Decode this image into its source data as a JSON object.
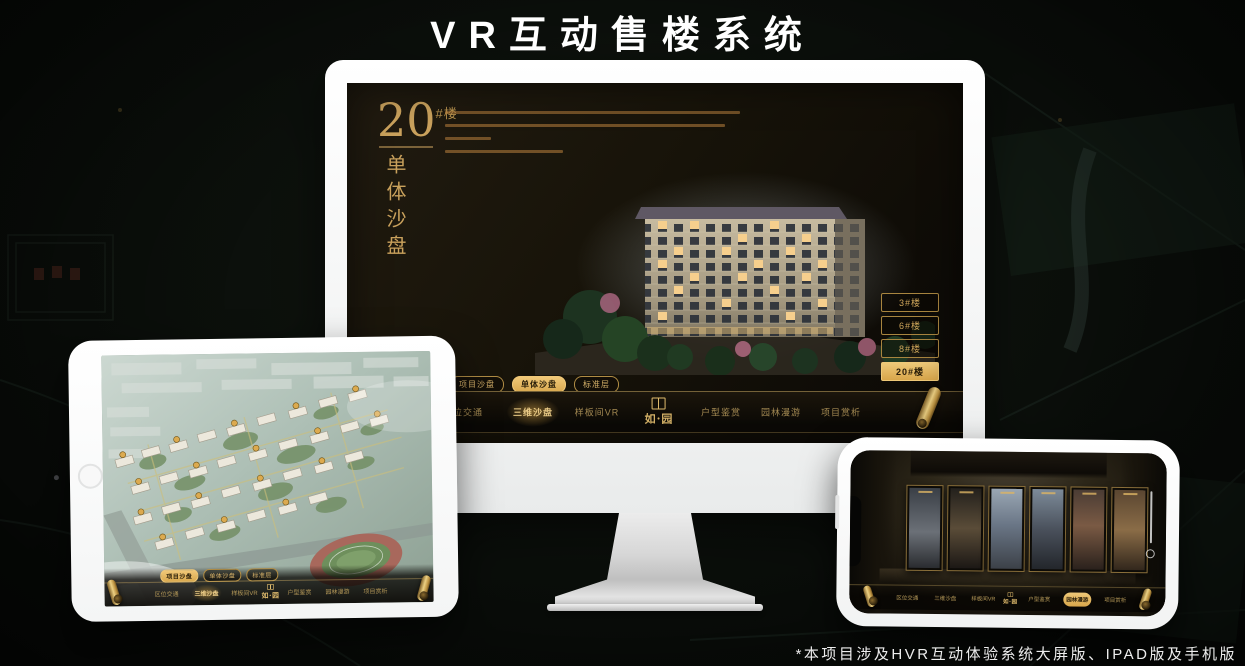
{
  "page": {
    "title": "VR互动售楼系统",
    "footnote": "*本项目涉及HVR互动体验系统大屏版、IPAD版及手机版"
  },
  "brand": {
    "logo_text": "如·园"
  },
  "colors": {
    "gold": "#c9a15c",
    "gold_bright": "#eec878",
    "screen_dark": "#171309"
  },
  "desktop": {
    "building_label": {
      "number": "20",
      "suffix": "#楼",
      "subtitle_vertical": "单体沙盘"
    },
    "floor_buttons": [
      {
        "label": "3#楼",
        "active": false
      },
      {
        "label": "6#楼",
        "active": false
      },
      {
        "label": "8#楼",
        "active": false
      },
      {
        "label": "20#楼",
        "active": true
      }
    ],
    "sub_tabs": [
      {
        "label": "项目沙盘",
        "active": false
      },
      {
        "label": "单体沙盘",
        "active": true
      },
      {
        "label": "标准层",
        "active": false
      }
    ],
    "nav_items": [
      {
        "label": "区位交通",
        "active": false
      },
      {
        "label": "三维沙盘",
        "active": true
      },
      {
        "label": "样板间VR",
        "active": false
      },
      {
        "label": "户型鉴赏",
        "active": false
      },
      {
        "label": "园林漫游",
        "active": false
      },
      {
        "label": "项目赏析",
        "active": false
      }
    ]
  },
  "tablet": {
    "sub_tabs": [
      {
        "label": "项目沙盘",
        "active": true
      },
      {
        "label": "单体沙盘",
        "active": false
      },
      {
        "label": "标准层",
        "active": false
      }
    ],
    "nav_items": [
      {
        "label": "区位交通",
        "active": false
      },
      {
        "label": "三维沙盘",
        "active": true
      },
      {
        "label": "样板间VR",
        "active": false
      },
      {
        "label": "户型鉴赏",
        "active": false
      },
      {
        "label": "园林漫游",
        "active": false
      },
      {
        "label": "项目赏析",
        "active": false
      }
    ]
  },
  "phone": {
    "nav_items": [
      {
        "label": "区位交通",
        "active": false
      },
      {
        "label": "三维沙盘",
        "active": false
      },
      {
        "label": "样板间VR",
        "active": false
      },
      {
        "label": "户型鉴赏",
        "active": false
      },
      {
        "label": "园林漫游",
        "active": true
      },
      {
        "label": "项目赏析",
        "active": false
      }
    ]
  }
}
